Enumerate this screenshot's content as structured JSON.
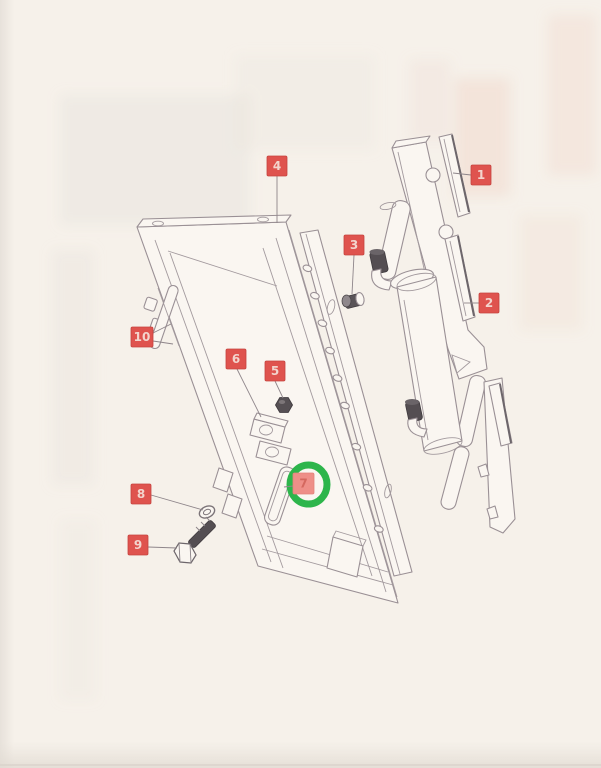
{
  "figure": {
    "type": "exploded-parts-diagram",
    "description": "Photographed catalog page: exploded view of a mounting-plate / cylinder assembly with numbered callouts",
    "paper_color": "#f5f0ea",
    "line_color": "#9a9095",
    "leader_color": "#8e858a",
    "label_style": {
      "bg": "#df534e",
      "border": "#c6443f",
      "text_color": "#f3d4cd",
      "size": 20
    },
    "highlight": {
      "target_label": "7",
      "color": "#2db54b",
      "cx": 308.5,
      "cy": 484.5,
      "rx": 18.5,
      "ry": 19.5,
      "stroke_width": 7
    },
    "labels": [
      {
        "id": "1",
        "text": "1",
        "x": 471,
        "y": 165,
        "leaders": [
          [
            471,
            175,
            453,
            173
          ]
        ]
      },
      {
        "id": "2",
        "text": "2",
        "x": 479,
        "y": 293,
        "leaders": [
          [
            479,
            303,
            464,
            303
          ]
        ]
      },
      {
        "id": "3",
        "text": "3",
        "x": 344,
        "y": 235,
        "leaders": [
          [
            354,
            255,
            352,
            294
          ]
        ]
      },
      {
        "id": "4",
        "text": "4",
        "x": 267,
        "y": 156,
        "leaders": [
          [
            277,
            176,
            277,
            223
          ]
        ]
      },
      {
        "id": "5",
        "text": "5",
        "x": 265,
        "y": 361,
        "leaders": [
          [
            275,
            381,
            283,
            398
          ]
        ]
      },
      {
        "id": "6",
        "text": "6",
        "x": 226,
        "y": 349,
        "leaders": [
          [
            237,
            369,
            261,
            417
          ]
        ]
      },
      {
        "id": "7",
        "text": "7",
        "x": 293,
        "y": 473,
        "w": 21,
        "h": 21,
        "bg": "#ee8f88",
        "border": "#e4837b",
        "text_color": "#d4685f",
        "leaders": [
          [
            293,
            486,
            284,
            487
          ]
        ]
      },
      {
        "id": "8",
        "text": "8",
        "x": 131,
        "y": 484,
        "leaders": [
          [
            151,
            495,
            203,
            510
          ]
        ]
      },
      {
        "id": "9",
        "text": "9",
        "x": 128,
        "y": 535,
        "leaders": [
          [
            148,
            547,
            177,
            548
          ]
        ]
      },
      {
        "id": "10",
        "text": "10",
        "x": 131,
        "y": 327,
        "w": 22,
        "leaders": [
          [
            153,
            333,
            171,
            324
          ],
          [
            153,
            341,
            173,
            344
          ]
        ]
      }
    ]
  }
}
